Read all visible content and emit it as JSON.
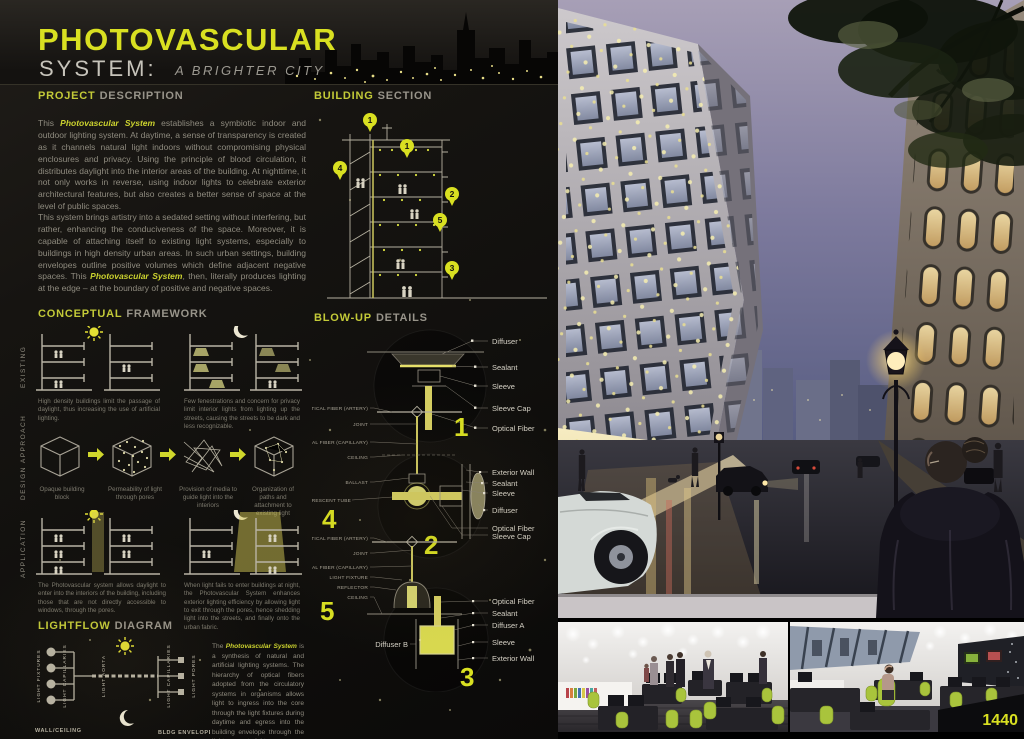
{
  "colors": {
    "accent": "#d9e021",
    "panel_bg": "#14120f",
    "body_text": "#8f8b7f"
  },
  "header": {
    "title": "PHOTOVASCULAR",
    "subtitle": "SYSTEM:",
    "tagline": "A BRIGHTER CITY"
  },
  "project": {
    "heading_em": "PROJECT",
    "heading_rest": "DESCRIPTION",
    "p1_pre": "This ",
    "p1_em": "Photovascular System",
    "p1_post": " establishes a symbiotic indoor and outdoor lighting system. At daytime, a sense of transparency is created as it channels natural light indoors without compromising physical enclosures and privacy. Using the principle of blood circulation, it distributes daylight into the interior areas of the building. At nighttime, it not only works in reverse, using indoor lights to celebrate exterior architectural features, but also creates a better sense of space at the level of public spaces.",
    "p2_pre": "This system brings artistry into a sedated setting without interfering, but rather, enhancing the conduciveness of the space. Moreover, it is capable of attaching itself to existing light systems, especially to buildings in high density urban areas. In such urban settings, building envelopes outline positive volumes which define adjacent negative spaces. This ",
    "p2_em": "Photovascular System",
    "p2_post": ", then, literally produces lighting at the edge – at the boundary of positive and negative spaces."
  },
  "conceptual": {
    "heading_em": "CONCEPTUAL",
    "heading_rest": "FRAMEWORK",
    "row_labels": [
      "EXISTING",
      "DESIGN APPROACH",
      "APPLICATION"
    ],
    "existing_captions": [
      "High density buildings limit the passage of daylight, thus increasing the use of artificial lighting.",
      "Few fenestrations and concern for privacy limit interior lights from lighting up the streets, causing the streets to be dark and less recognizable."
    ],
    "design_captions": [
      "Opaque building block",
      "Permeability of light through pores",
      "Provision of media to guide light into the interiors",
      "Organization of paths and attachment to existing light"
    ],
    "application_captions": [
      "The Photovascular system allows daylight to enter into the interiors of the building, including those that are not directly accessible to windows, through the pores.",
      "When light fails to enter buildings at night, the Photovascular System enhances exterior lighting efficiency by allowing light to exit through the pores, hence shedding light into the streets, and finally onto the urban fabric."
    ]
  },
  "lightflow": {
    "heading_em": "LIGHTFLOW",
    "heading_rest": "DIAGRAM",
    "labels": [
      "LIGHT FIXTURES",
      "LIGHT CAPILLARIES",
      "LIGHT AORTA",
      "LIGHT CAPILLARIES",
      "LIGHT PORES"
    ],
    "bottom_labels": [
      "WALL/CEILING",
      "BLDG ENVELOPE"
    ],
    "p_pre": "The ",
    "p_em": "Photovascular System",
    "p_post": " is a synthesis of natural and artificial lighting systems. The hierarchy of optical fibers adopted from the circulatory systems in organisms allows light to ingress into the core through the light fixtures during daytime and egress into the building envelope through the light pores at night."
  },
  "building_section": {
    "heading_em": "BUILDING",
    "heading_rest": "SECTION",
    "markers": [
      "1",
      "1",
      "4",
      "2",
      "5",
      "3"
    ]
  },
  "details": {
    "heading_em": "BLOW-UP",
    "heading_rest": "DETAILS",
    "d1": {
      "num": "1",
      "labels": [
        "Diffuser",
        "Sealant",
        "Sleeve",
        "Sleeve Cap",
        "Optical Fiber"
      ]
    },
    "d4": {
      "num": "4",
      "labels": [
        "OPTICAL FIBER (ARTERY)",
        "JOINT",
        "OPTICAL FIBER (CAPILLARY)",
        "CEILING",
        "BALLAST",
        "FLUORESCENT TUBE"
      ]
    },
    "d2": {
      "num": "2",
      "labels": [
        "Exterior Wall",
        "Sealant",
        "Sleeve",
        "Diffuser",
        "Optical Fiber",
        "Sleeve Cap"
      ]
    },
    "d5": {
      "num": "5",
      "labels": [
        "OPTICAL FIBER (ARTERY)",
        "JOINT",
        "OPTICAL FIBER (CAPILLARY)",
        "LIGHT FIXTURE",
        "REFLECTOR",
        "CEILING"
      ]
    },
    "d3": {
      "num": "3",
      "labels": [
        "Optical Fiber",
        "Sealant",
        "Diffuser A",
        "Sleeve",
        "Exterior Wall"
      ],
      "left_label": "Diffuser B"
    }
  },
  "badge": {
    "number": "1440"
  }
}
